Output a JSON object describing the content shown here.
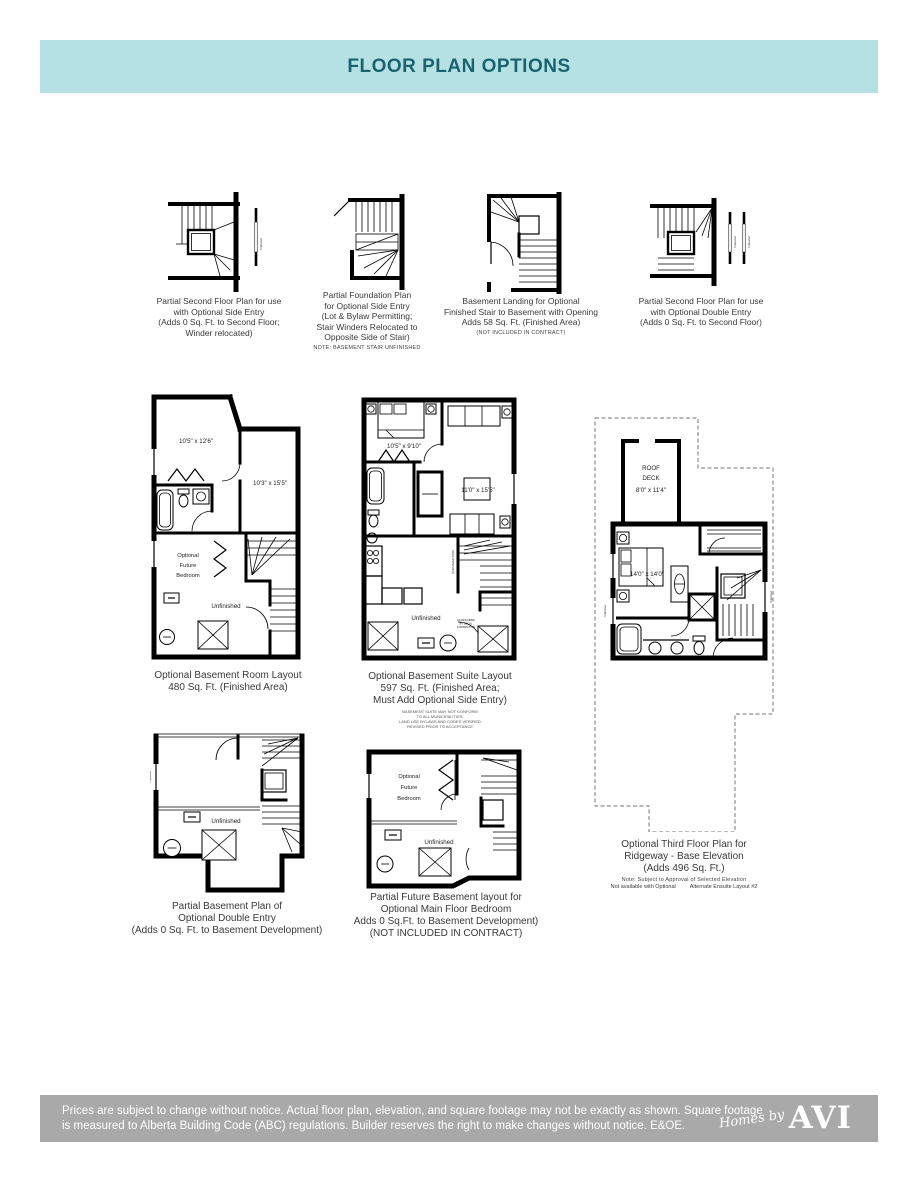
{
  "header": {
    "title": "FLOOR PLAN OPTIONS"
  },
  "labels": {
    "optional": "Optional",
    "stair_note": "UNFINISHED STAIR"
  },
  "small_plans": [
    {
      "caption": [
        "Partial Second Floor Plan for use",
        "with Optional Side Entry",
        "(Adds 0 Sq. Ft. to Second Floor;",
        "Winder relocated)"
      ]
    },
    {
      "caption": [
        "Partial Foundation Plan",
        "for Optional Side Entry",
        "(Lot & Bylaw Permitting;",
        "Stair Winders Relocated to",
        "Opposite Side of Stair)"
      ],
      "note": "NOTE: BASEMENT STAIR UNFINISHED"
    },
    {
      "caption": [
        "Basement Landing for Optional",
        "Finished Stair to Basement with Opening",
        "Adds 58 Sq. Ft. (Finished Area)"
      ],
      "note": "(NOT INCLUDED IN CONTRACT)"
    },
    {
      "caption": [
        "Partial Second Floor Plan for use",
        "with Optional Double Entry",
        "(Adds 0 Sq. Ft. to Second Floor)"
      ]
    }
  ],
  "basement_room_plan": {
    "rooms": {
      "room1": "10'5\" x 12'6\"",
      "room2": "10'3\" x 15'5\"",
      "future_bedroom": [
        "Optional",
        "Future",
        "Bedroom"
      ],
      "unfinished": "Unfinished"
    },
    "caption": [
      "Optional Basement Room Layout",
      "480 Sq. Ft. (Finished Area)"
    ]
  },
  "basement_suite_plan": {
    "rooms": {
      "bedroom": "10'5\" x 9'10\"",
      "living": "11'0\" x 15'5\"",
      "unfinished": "Unfinished"
    },
    "jurisdiction_note": [
      "AS REQUIRED",
      "BY LOCAL",
      "JURISDICTION"
    ],
    "caption": [
      "Optional Basement Suite Layout",
      "597 Sq. Ft. (Finished Area;",
      "Must Add Optional Side Entry)"
    ],
    "fine_print": [
      "BASEMENT SUITE MAY NOT CONFORM",
      "TO ALL MUNICIPALITIES;",
      "LAND USE BYLAWS AND CODES VERIFIED",
      "REVISED PRIOR TO ACCEPTANCE"
    ]
  },
  "third_floor_plan": {
    "rooms": {
      "roof_deck": [
        "ROOF",
        "DECK",
        "8'0\" x 11'4\""
      ],
      "bedroom": "14'0\" x 14'0\""
    },
    "caption": [
      "Optional Third Floor Plan for",
      "Ridgeway - Base Elevation",
      "(Adds 496 Sq. Ft.)"
    ],
    "note1": "Note: Subject to Approval of Selected Elevation",
    "note2a": "Not available with Optional",
    "note2b": "Alternate Ensuite Layout #2"
  },
  "double_entry_basement_plan": {
    "rooms": {
      "unfinished": "Unfinished"
    },
    "caption": [
      "Partial Basement Plan of",
      "Optional Double Entry",
      "(Adds 0 Sq. Ft. to Basement Development)"
    ]
  },
  "future_bedroom_basement_plan": {
    "rooms": {
      "future_bedroom": [
        "Optional",
        "Future",
        "Bedroom"
      ],
      "unfinished": "Unfinished"
    },
    "caption": [
      "Partial Future Basement layout for",
      "Optional Main Floor Bedroom",
      "Adds 0 Sq.Ft. to Basement Development)",
      "(NOT INCLUDED IN CONTRACT)"
    ]
  },
  "footer": {
    "disclaimer_line1": "Prices are subject to change without notice. Actual floor plan, elevation, and square footage may not be exactly as shown. Square footage",
    "disclaimer_line2": "is measured to Alberta Building Code (ABC) regulations. Builder reserves the right to make changes without notice. E&OE.",
    "logo_script": "Homes by",
    "logo_serif": "AVI"
  },
  "colors": {
    "header_bg": "#b5e1e4",
    "header_text": "#19646f",
    "footer_bg": "#a9a9a9",
    "footer_text": "#ffffff",
    "wall": "#000000"
  }
}
